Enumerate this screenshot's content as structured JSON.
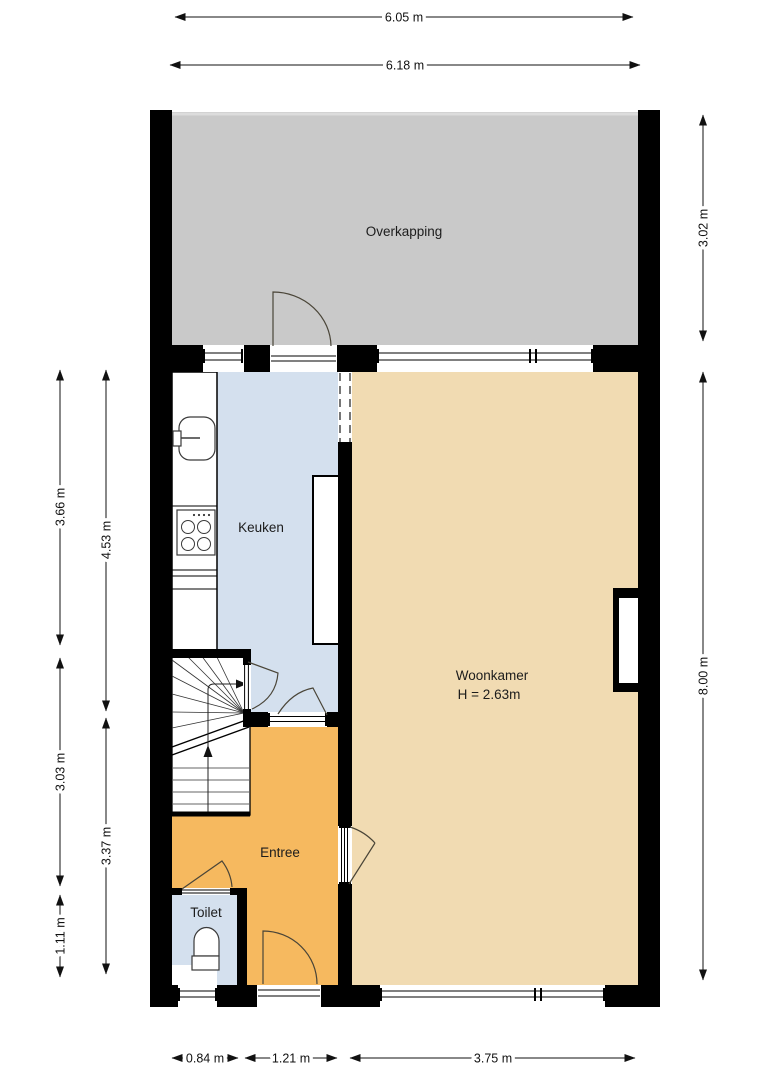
{
  "plan": {
    "rooms": {
      "overkapping": "Overkapping",
      "keuken": "Keuken",
      "woonkamer": "Woonkamer",
      "woonkamer_height": "H = 2.63m",
      "entree": "Entree",
      "toilet": "Toilet"
    },
    "dimensions": {
      "top_outer": "6.05 m",
      "top_inner": "6.18 m",
      "left_kitchen": "3.66 m",
      "left_kitchen_total": "4.53 m",
      "left_stairs": "3.03 m",
      "left_entree": "3.37 m",
      "left_toilet": "1.11 m",
      "right_overkapping": "3.02 m",
      "right_house": "8.00 m",
      "bottom_toilet": "0.84 m",
      "bottom_entree": "1.21 m",
      "bottom_woonkamer": "3.75 m"
    },
    "colors": {
      "wall": "#000000",
      "overkapping_fill": "#c9c9c9",
      "keuken_fill": "#d4e0ee",
      "woonkamer_fill": "#f1dbb2",
      "entree_fill": "#f6b95f",
      "toilet_fill": "#d4e0ee",
      "background": "#ffffff"
    }
  }
}
